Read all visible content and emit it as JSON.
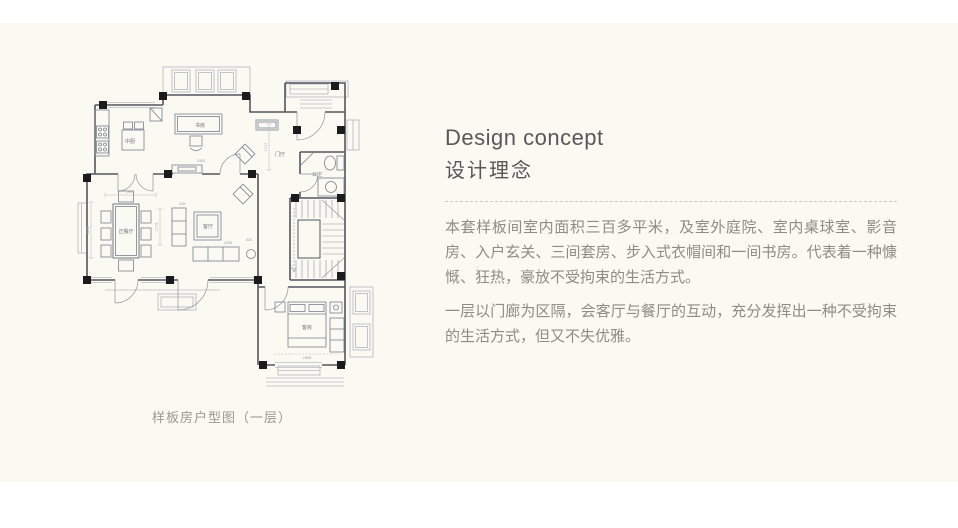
{
  "panel": {
    "background": "#FAF9F2"
  },
  "concept": {
    "title_en": "Design concept",
    "title_zh": "设计理念",
    "paragraphs": [
      "本套样板间室内面积三百多平米，及室外庭院、室内桌球室、影音房、入户玄关、三间套房、步入式衣帽间和一间书房。代表着一种慷慨、狂热，豪放不受拘束的生活方式。",
      "一层以门廊为区隔，会客厅与餐厅的互动，充分发挥出一种不受拘束的生活方式，但又不失优雅。"
    ]
  },
  "floorplan": {
    "caption": "样板房户型图（一层）",
    "rooms": {
      "kitchen": "中厨",
      "study": "书房",
      "foyer": "门厅",
      "bath": "公卫",
      "dining": "正餐厅",
      "living": "客厅",
      "guest": "客房"
    },
    "dims": {
      "d1": "1995",
      "d2": "2206",
      "d3": "1552",
      "d4": "2255",
      "d5": "1779",
      "d6": "1717",
      "d7": "2065",
      "d8": "415",
      "d9": "520"
    },
    "colors": {
      "wall": "#53565F",
      "thin": "#9AA0AC",
      "furniture": "#7B8090",
      "column": "#1B1B1E"
    }
  }
}
